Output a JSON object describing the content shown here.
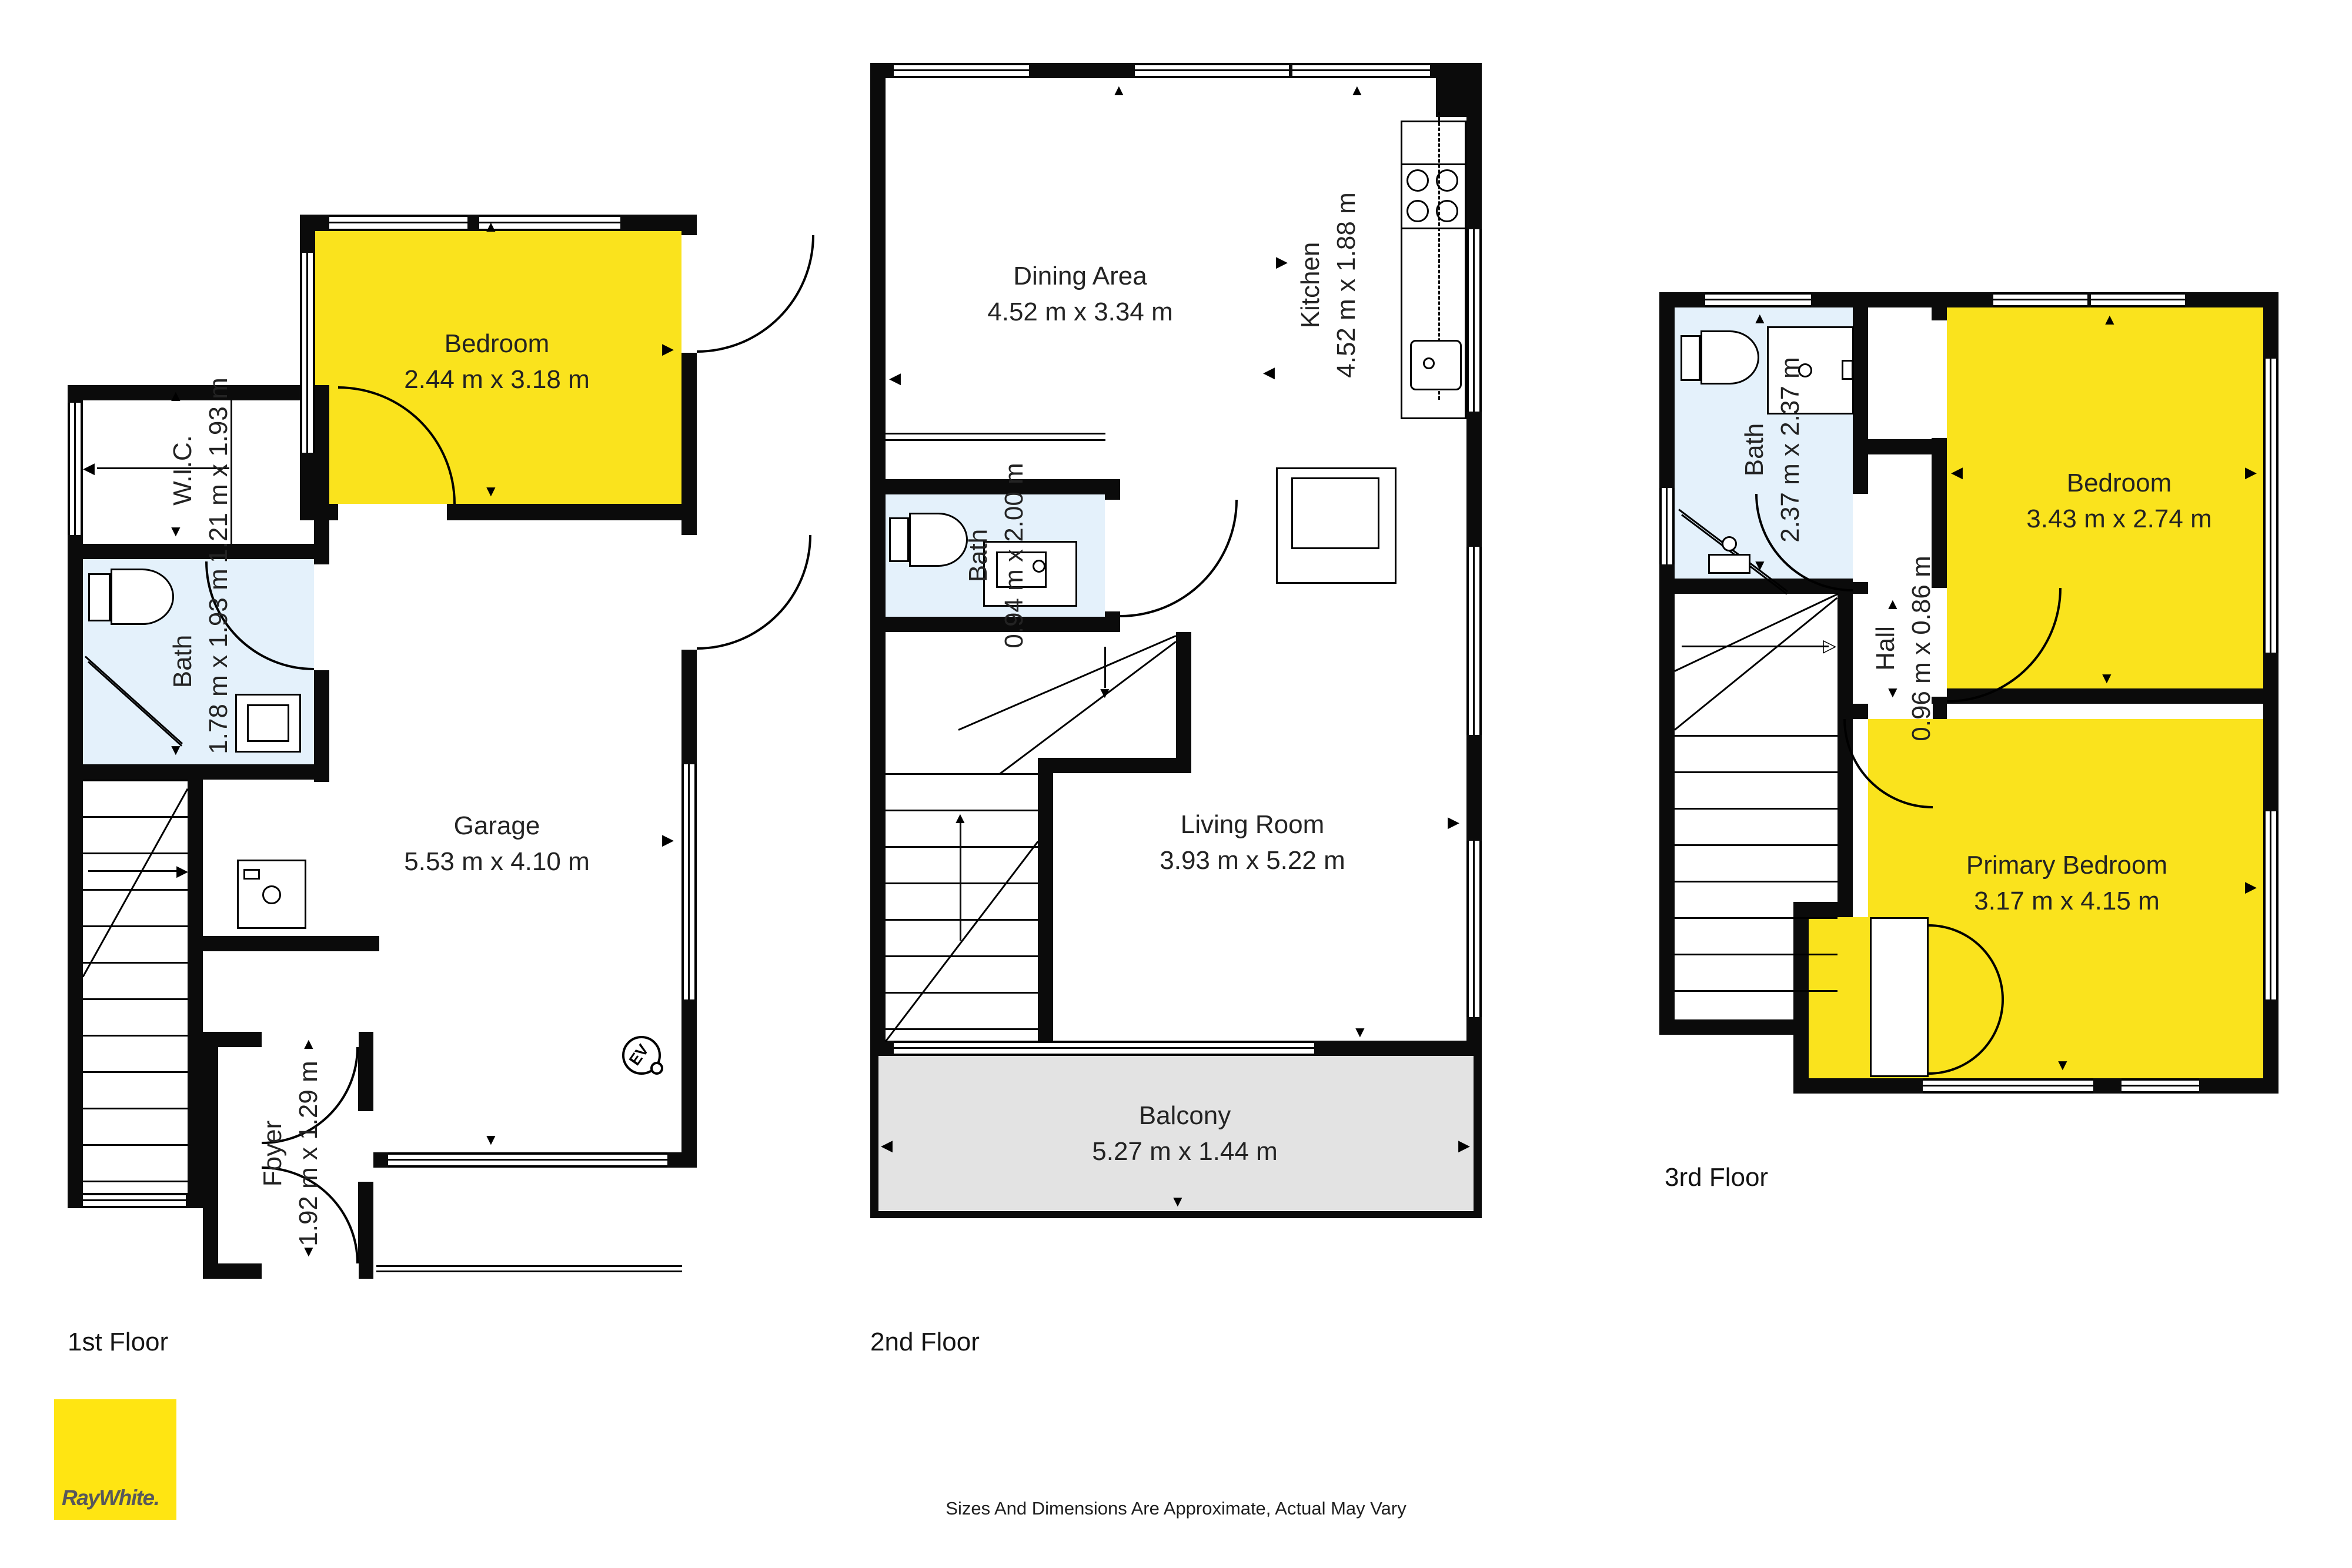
{
  "title": "Three level residential floor plan",
  "colors": {
    "room_highlight_yellow": "#FAE31D",
    "bath_blue": "#E4F1FB",
    "balcony_gray": "#E3E3E3",
    "wall_black": "#0B0B0B",
    "logo_yellow": "#FFE512",
    "logo_text_gray": "#58585B"
  },
  "floors": [
    {
      "label": "1st Floor",
      "rooms": [
        {
          "name": "Bedroom",
          "dims": "2.44 m x 3.18 m"
        },
        {
          "name": "W.I.C.",
          "dims": "1.21 m x 1.93 m"
        },
        {
          "name": "Bath",
          "dims": "1.78 m x 1.93 m"
        },
        {
          "name": "Garage",
          "dims": "5.53 m x 4.10 m"
        },
        {
          "name": "Foyer",
          "dims": "1.92 m x 1.29 m"
        }
      ],
      "icons": [
        {
          "name": "ev-charger",
          "label": "EV"
        }
      ]
    },
    {
      "label": "2nd Floor",
      "rooms": [
        {
          "name": "Dining Area",
          "dims": "4.52 m x 3.34 m"
        },
        {
          "name": "Kitchen",
          "dims": "4.52 m x 1.88 m"
        },
        {
          "name": "Bath",
          "dims": "0.94 m x 2.00 m"
        },
        {
          "name": "Living Room",
          "dims": "3.93 m x 5.22 m"
        },
        {
          "name": "Balcony",
          "dims": "5.27 m x 1.44 m"
        }
      ]
    },
    {
      "label": "3rd Floor",
      "rooms": [
        {
          "name": "Bath",
          "dims": "2.37 m x 2.37 m"
        },
        {
          "name": "Bedroom",
          "dims": "3.43 m x 2.74 m"
        },
        {
          "name": "Hall",
          "dims": "0.96 m x 0.86 m"
        },
        {
          "name": "Primary Bedroom",
          "dims": "3.17 m x 4.15 m"
        }
      ]
    }
  ],
  "footer": {
    "disclaimer": "Sizes And Dimensions Are Approximate, Actual May Vary"
  },
  "brand": {
    "wordmark": "RayWhite."
  }
}
